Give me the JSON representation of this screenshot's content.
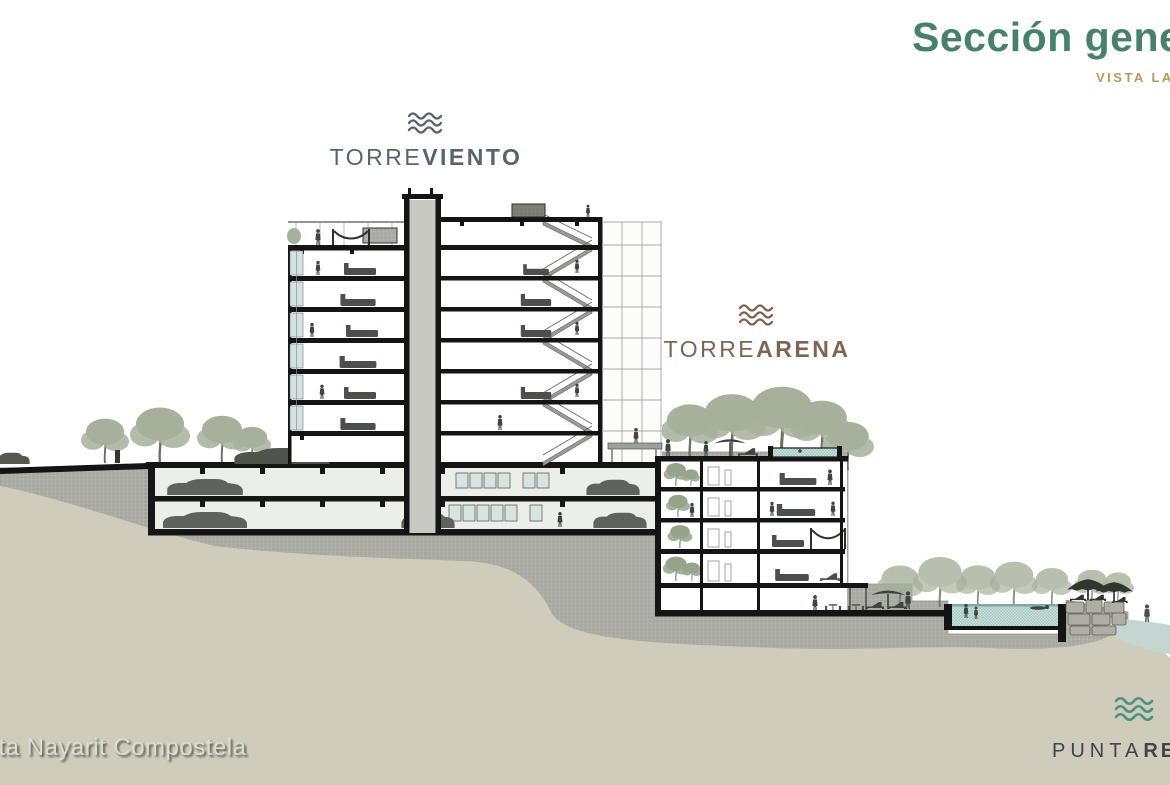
{
  "slide": {
    "header": {
      "title": "Sección general",
      "subtitle": "VISTA LATERAL"
    },
    "tower_labels": {
      "viento": {
        "prefix": "TORRE",
        "suffix": "VIENTO"
      },
      "arena": {
        "prefix": "TORRE",
        "suffix": "ARENA"
      }
    },
    "watermark": "rta Nayarit Compostela",
    "brand": {
      "prefix": "PUNTA",
      "suffix": "RE"
    },
    "colors": {
      "title": "#47806b",
      "subtitle": "#b39a5d",
      "torre_viento": "#57646f",
      "torre_arena": "#7d6453",
      "brand_text": "#3e444a",
      "brand_wave": "#4d9180",
      "earth_hatch": "#b5b7af",
      "soil": "#cfccbb",
      "sea": "#c5d6d2",
      "pool_water": "#bcd7d3",
      "trees": "#a6b09b",
      "drawing_ink": "#161616"
    }
  }
}
